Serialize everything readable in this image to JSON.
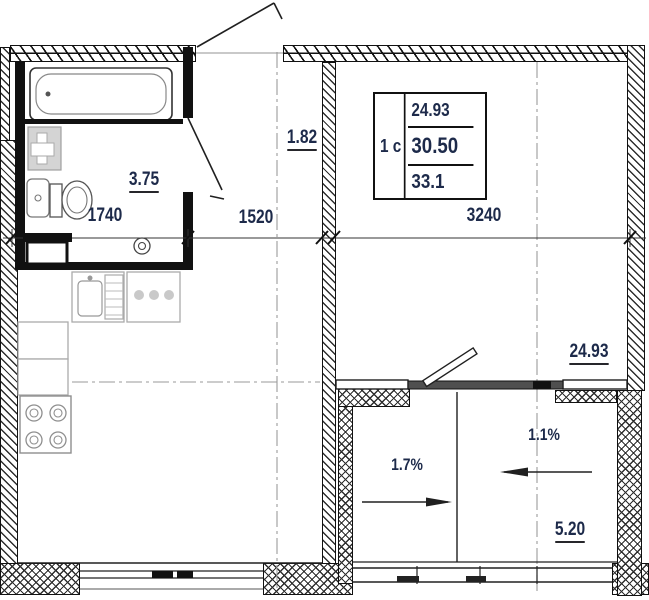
{
  "title": "apartment floor plan 1s-studio",
  "unit_table": {
    "type": "1 с",
    "rows": [
      "24.93",
      "30.50",
      "33.1"
    ]
  },
  "areas": {
    "bathroom": "3.75",
    "hallway": "1.82",
    "living": "24.93",
    "balcony": "5.20"
  },
  "dimensions": {
    "bathroom_width": "1740",
    "hallway_width": "1520",
    "living_width": "3240"
  },
  "slopes": {
    "left": "1.7%",
    "right": "1.1%"
  },
  "colors": {
    "ink": "#1d2a4a",
    "wall": "#111111",
    "window_bar": "#4f4f4f",
    "furniture": "#ababab",
    "axis": "#9a9a9a"
  }
}
